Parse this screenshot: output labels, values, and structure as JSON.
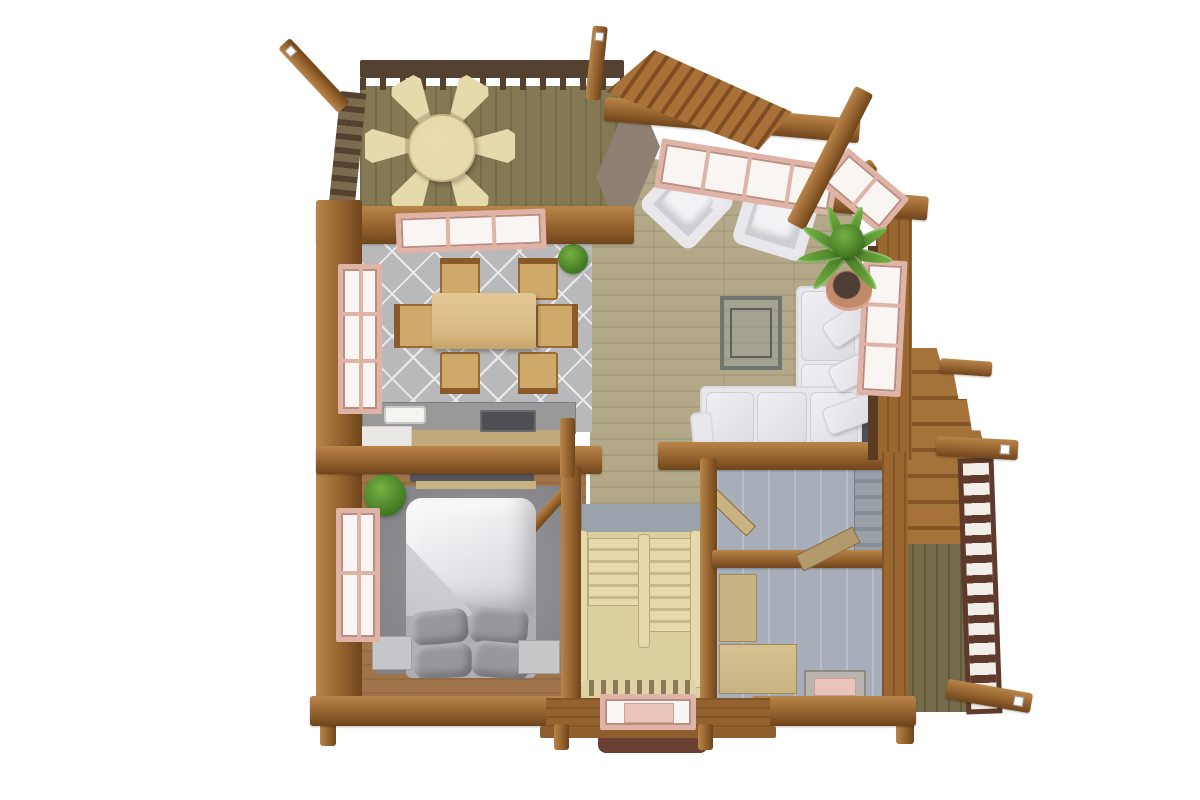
{
  "scene": {
    "type": "3d-floor-plan-render",
    "view": "top-down",
    "subject": "log cabin upper floor with open deck",
    "background": "#ffffff"
  },
  "palette": {
    "bg": "#ffffff",
    "log_hi": "#b8854a",
    "log_mid": "#94622e",
    "log_dark": "#6f451c",
    "wall_v": "#9a6731",
    "deck_floor": "#857953",
    "rail_dark": "#554130",
    "hall_floor": "#b3a989",
    "tile": "#b9b9bb",
    "tile_line": "#ebebec",
    "carpet": "#838286",
    "bedroom_floor": "#a0744a",
    "counter_top": "#99999a",
    "counter_front": "#c2a97b",
    "cabinet_white": "#e9e8e4",
    "stove": "#4f4f53",
    "sink": "#f4f4f2",
    "table_tan": "#d9ba84",
    "chair_tan": "#cfa96a",
    "chair_trim": "#8a5a2a",
    "cream": "#e6d9ac",
    "stair_bg": "#dccf9f",
    "stair_step": "#c8b88a",
    "sofa": "#e8e7eb",
    "sofa_dim": "#cfced4",
    "gap_dark": "#4e4e52",
    "bed_white": "#ededef",
    "bed_fold": "#c6c6cb",
    "bed_sheet": "#aeaeb3",
    "pillow": "#97979c",
    "nightstand": "#c5c7c9",
    "bath_floor": "#a7aeb9",
    "cab_tan": "#c8b482",
    "plant_hi": "#74b143",
    "plant_lo": "#3f7420",
    "pot": "#c08a6b",
    "win_frame": "#dfb3a6",
    "win_frame_dk": "#bb8d80",
    "win_pane": "#f8f5f2",
    "balcony_floor": "#756c4c",
    "balcony_rail": "#5e392c",
    "awning": "#6b4034",
    "roof_hi": "#a8713a",
    "roof_lo": "#7e4e22",
    "roof_gray": "#8e8174",
    "back_wall_gray": "#9aa2ab",
    "wood_step": "#a57239",
    "wood_step_dk": "#835527"
  },
  "rooms": [
    {
      "id": "deck",
      "label": "Open deck with round table and 6 wedge chairs",
      "floor": "olive wood planks",
      "furniture": [
        "round-table",
        "deck-chair x6",
        "slat-railing",
        "corner-posts"
      ]
    },
    {
      "id": "sunroom",
      "label": "Sunroom lounge with angled bay windows",
      "floor": "light wood planks",
      "furniture": [
        "armchair x2",
        "potted-fern",
        "log-roof-beams",
        "shingled-entry-roof"
      ]
    },
    {
      "id": "dining-room",
      "label": "Dining room",
      "floor": "gray diamond tile",
      "furniture": [
        "dining-table",
        "dining-chair x6",
        "small-plant",
        "skylight-window",
        "side-window"
      ]
    },
    {
      "id": "kitchen",
      "label": "Kitchen counter run",
      "floor": "gray diamond tile",
      "furniture": [
        "counter",
        "sink",
        "stove",
        "white-cabinet"
      ]
    },
    {
      "id": "living-room",
      "label": "Living room",
      "floor": "light wood planks",
      "furniture": [
        "l-shaped-sofa",
        "throw-cushion x3",
        "coffee-table",
        "window"
      ]
    },
    {
      "id": "bedroom",
      "label": "Bedroom",
      "floor": "gray carpet over wood",
      "furniture": [
        "double-bed",
        "pillow x4",
        "nightstand x2",
        "dresser",
        "plant",
        "open-door",
        "window"
      ]
    },
    {
      "id": "staircase",
      "label": "U-shaped staircase",
      "floor": "cream",
      "furniture": [
        "flight x2",
        "stringer",
        "baluster-row",
        "bottom-window"
      ]
    },
    {
      "id": "bath-upper",
      "label": "Upper utility/bath room",
      "floor": "blue-gray panels",
      "furniture": [
        "open-door",
        "shelf-unit"
      ]
    },
    {
      "id": "bath-lower",
      "label": "Lower utility/storage room",
      "floor": "blue-gray panels",
      "furniture": [
        "tall-cabinet",
        "low-cabinet",
        "floor-hatch"
      ]
    },
    {
      "id": "balcony",
      "label": "Side balcony with exterior stairs",
      "floor": "dark olive planks",
      "furniture": [
        "square-hole-railing",
        "exterior-stairs",
        "log-beams"
      ]
    },
    {
      "id": "porch",
      "label": "Entry porch below stairwell",
      "floor": "wood planks",
      "furniture": [
        "window",
        "step",
        "awning",
        "post x2"
      ]
    }
  ]
}
